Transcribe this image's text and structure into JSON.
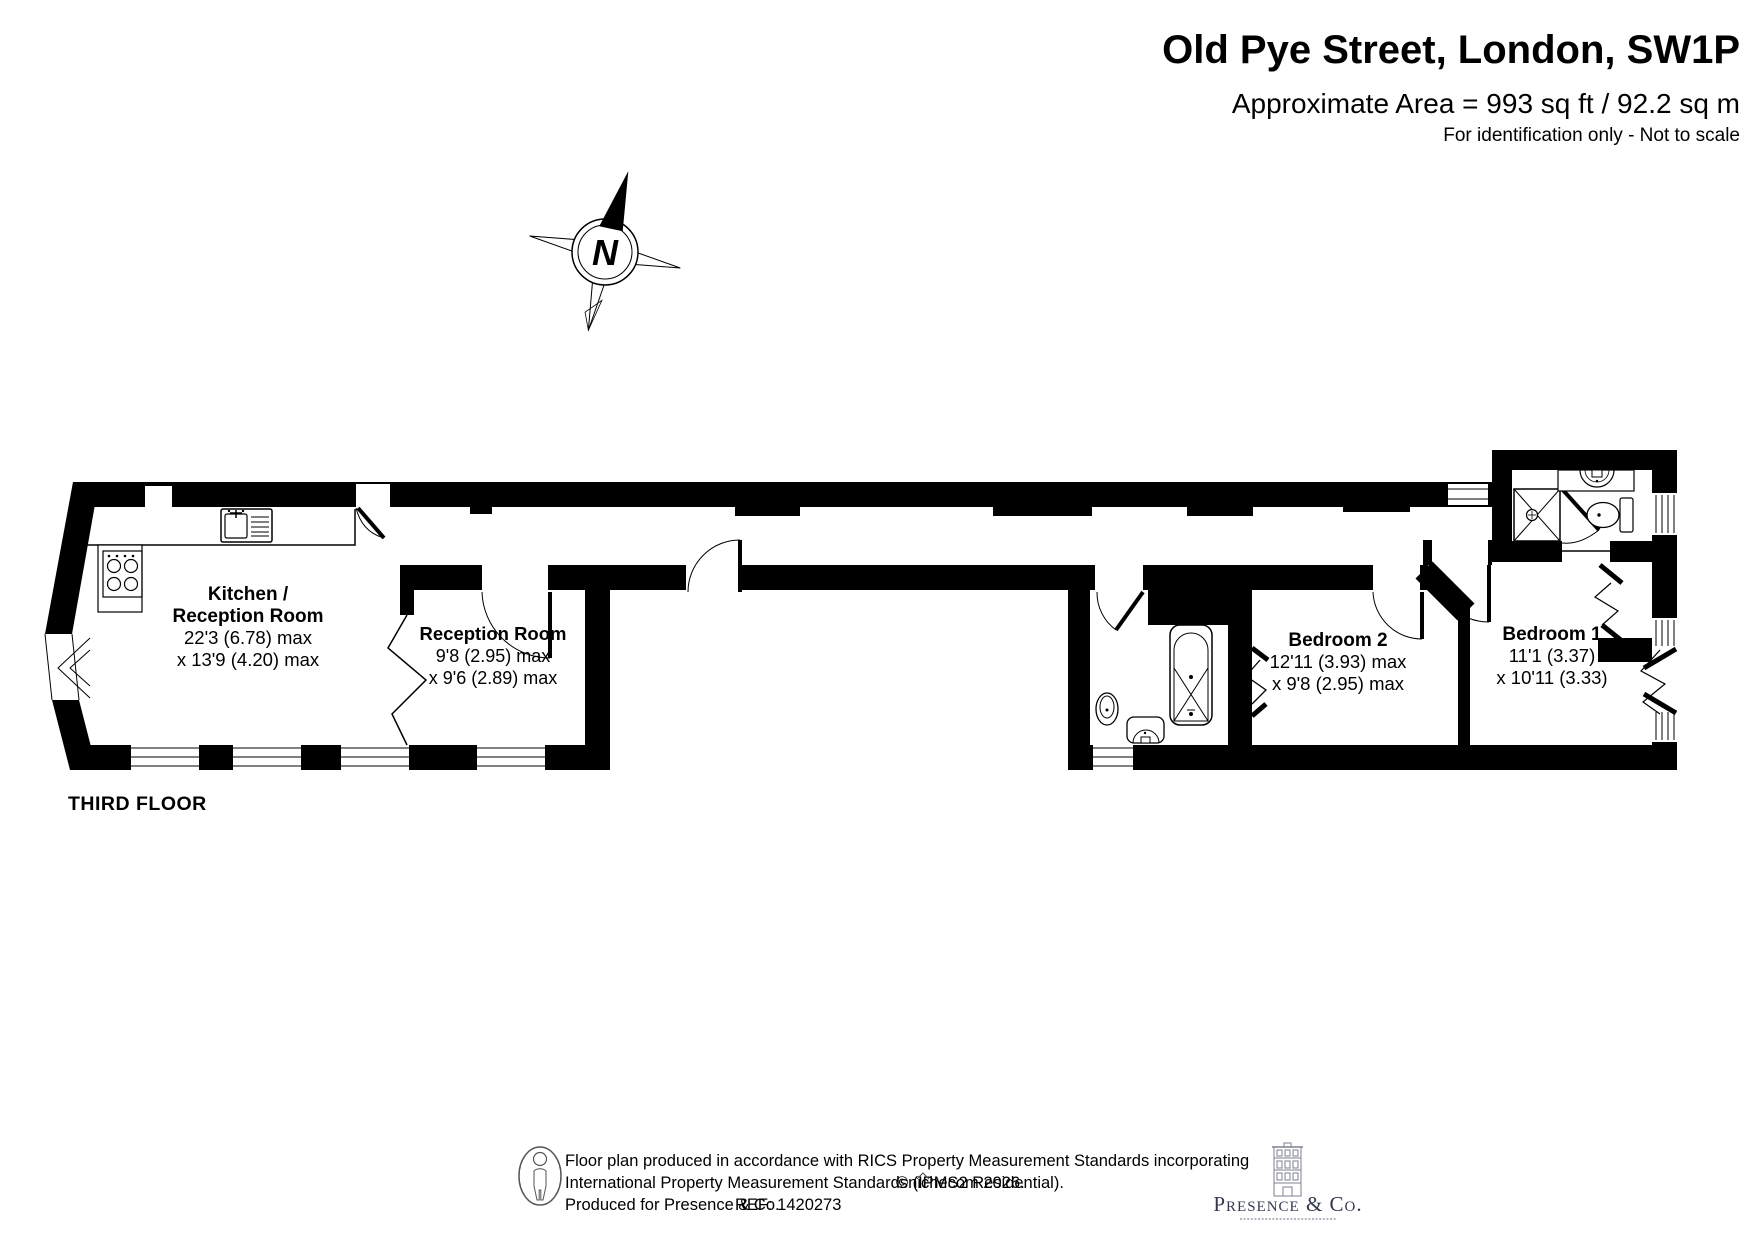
{
  "header": {
    "title": "Old Pye Street, London, SW1P",
    "area_line": "Approximate Area = 993 sq ft / 92.2 sq m",
    "disclaimer": "For identification only - Not to scale"
  },
  "compass": {
    "north_label": "N"
  },
  "floor_label": "THIRD FLOOR",
  "rooms": {
    "kitchen_reception": {
      "name_line1": "Kitchen /",
      "name_line2": "Reception Room",
      "dim_line1": "22'3 (6.78) max",
      "dim_line2": "x 13'9 (4.20) max"
    },
    "reception": {
      "name": "Reception Room",
      "dim_line1": "9'8 (2.95) max",
      "dim_line2": "x 9'6 (2.89) max"
    },
    "bedroom_2": {
      "name": "Bedroom 2",
      "dim_line1": "12'11 (3.93) max",
      "dim_line2": "x 9'8 (2.95) max"
    },
    "bedroom_1": {
      "name": "Bedroom 1",
      "dim_line1": "11'1 (3.37)",
      "dim_line2": "x 10'11 (3.33)"
    }
  },
  "footer": {
    "line1": "Floor plan produced in accordance with RICS Property Measurement Standards incorporating",
    "line2": "International Property Measurement Standards (IPMS2 Residential).",
    "line2_copyright": "©nichecom 2026.",
    "line3": "Produced for Presence & Co.",
    "line3_ref": "REF:  1420273"
  },
  "logo": {
    "company": "Presence & Co."
  },
  "colors": {
    "ink": "#000000",
    "footer_text": "#4a4a4a",
    "logo_ink": "#333a4e",
    "logo_detail": "#7b8292"
  }
}
